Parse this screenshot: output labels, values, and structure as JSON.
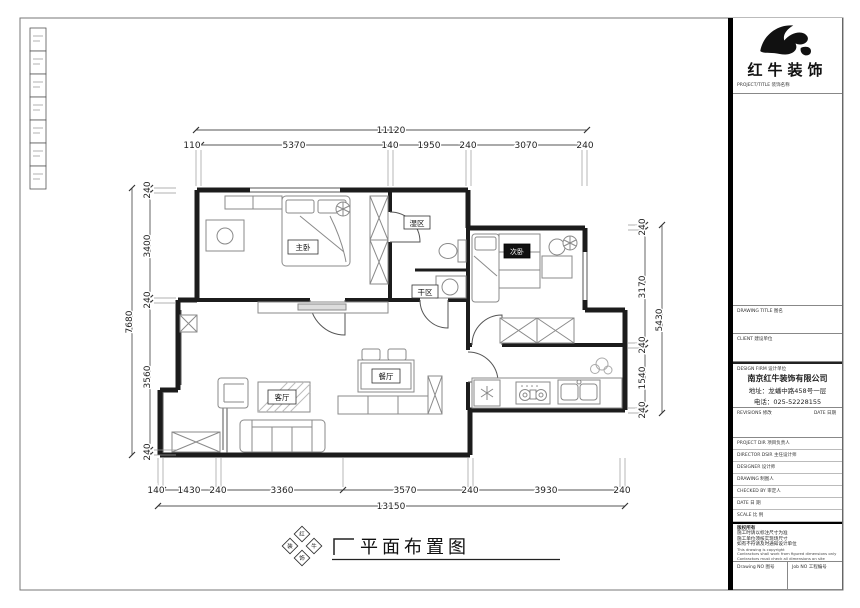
{
  "sheet": {
    "ink": "#1c1c1c"
  },
  "dims": {
    "top": {
      "total": "11120",
      "segments": [
        "110",
        "5370",
        "140",
        "1950",
        "240",
        "3070",
        "240"
      ]
    },
    "bottom": {
      "total": "13150",
      "segments": [
        "140",
        "1430",
        "240",
        "3360",
        "3570",
        "240",
        "3930",
        "240"
      ]
    },
    "left": {
      "total": "7680",
      "segments": [
        "240",
        "3400",
        "240",
        "3560",
        "240"
      ]
    },
    "right": {
      "total": "5430",
      "segments": [
        "240",
        "3170",
        "240",
        "1540",
        "240"
      ]
    }
  },
  "rooms": {
    "master_bedroom": "主卧",
    "bath_wet": "湿区",
    "bath_dry": "干区",
    "second_bedroom": "次卧",
    "living_room": "客厅",
    "dining_room": "餐厅"
  },
  "caption": {
    "title": "平面布置图",
    "stamp_chars": [
      "红",
      "牛",
      "装",
      "饰"
    ]
  },
  "title_block": {
    "brand": "红牛装饰",
    "brand_sub": "PROJECT/TITLE  装饰名称",
    "drawing_title_label": "DRAWING TITLE  图名",
    "client_label": "CLIENT  建设单位",
    "design_firm_label": "DESIGN FIRM  设计单位",
    "company": {
      "name": "南京红牛装饰有限公司",
      "address": "地址：龙蟠中路458号一层",
      "phone": "电话：025-52228155"
    },
    "revisions_label": "REVISIONS  修改",
    "date_label": "DATE  日期",
    "fields": [
      "PROJECT DIR  项目负责人",
      "DIRECTOR DSIR  主任设计师",
      "DESIGNER  设计师",
      "DRAWING  制图人",
      "CHECKED BY  审定人",
      "DATE  日  期",
      "SCALE  比  例"
    ],
    "notes_zh": [
      "版权所有",
      "施工时请以标注尺寸为准",
      "施工单位须核实现场尺寸",
      "如有不符请及时通知设计单位"
    ],
    "notes_en": [
      "This drawing is copyright",
      "Contractors shall work from figured dimensions only",
      "Contractors must check all dimensions on site",
      "Discrepancies must be reported immediately to architects"
    ],
    "drawing_no_label": "Drawing NO  图号",
    "job_no_label": "Job NO  工程编号"
  }
}
